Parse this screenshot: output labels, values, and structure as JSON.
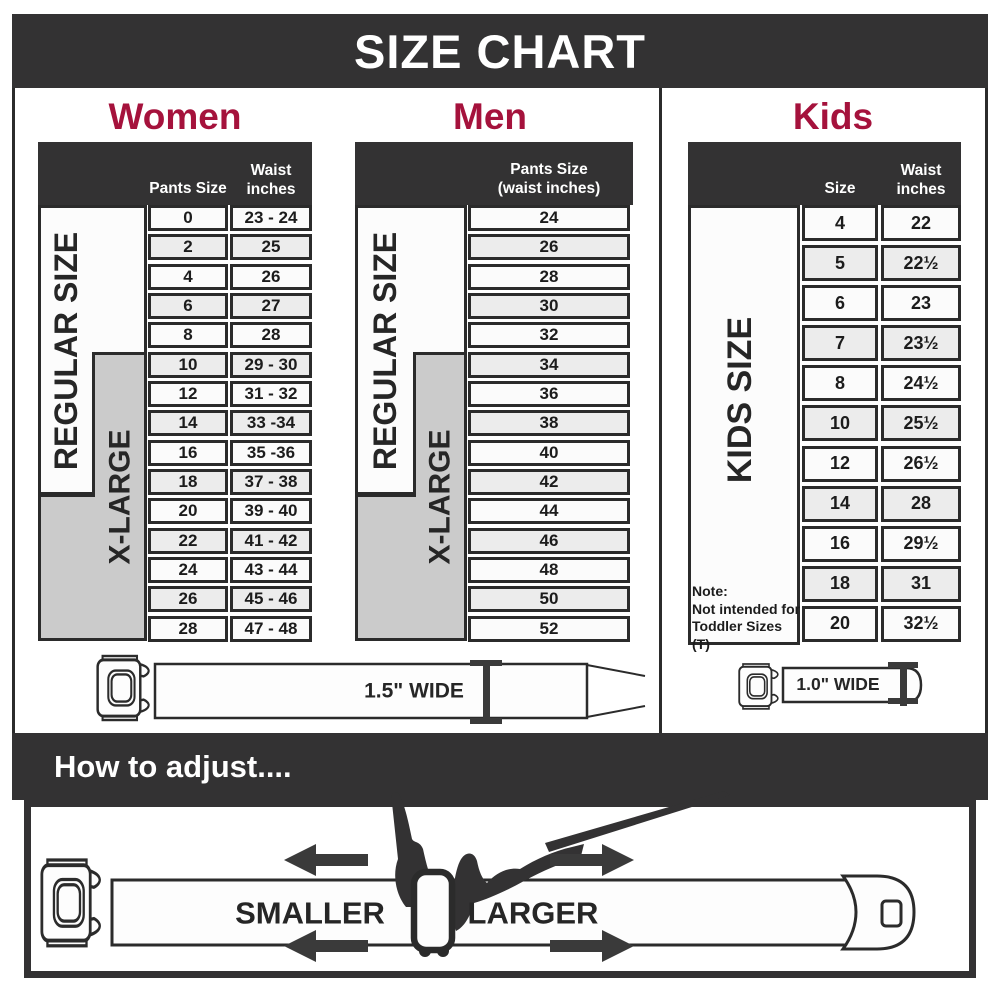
{
  "title": "SIZE CHART",
  "colors": {
    "accent_red": "#a5123c",
    "dark": "#333233",
    "gray_region": "#cbcbcb",
    "row_alt": "#ececec",
    "cell_border": "#2b2b2b"
  },
  "women": {
    "title": "Women",
    "header_size": "Pants Size",
    "header_waist_line1": "Waist",
    "header_waist_line2": "inches",
    "regular_label": "REGULAR SIZE",
    "xlarge_label": "X-LARGE",
    "rows": [
      {
        "size": "0",
        "waist": "23 - 24"
      },
      {
        "size": "2",
        "waist": "25"
      },
      {
        "size": "4",
        "waist": "26"
      },
      {
        "size": "6",
        "waist": "27"
      },
      {
        "size": "8",
        "waist": "28"
      },
      {
        "size": "10",
        "waist": "29 - 30"
      },
      {
        "size": "12",
        "waist": "31 - 32"
      },
      {
        "size": "14",
        "waist": "33 -34"
      },
      {
        "size": "16",
        "waist": "35 -36"
      },
      {
        "size": "18",
        "waist": "37 - 38"
      },
      {
        "size": "20",
        "waist": "39 - 40"
      },
      {
        "size": "22",
        "waist": "41 - 42"
      },
      {
        "size": "24",
        "waist": "43 - 44"
      },
      {
        "size": "26",
        "waist": "45 - 46"
      },
      {
        "size": "28",
        "waist": "47 - 48"
      }
    ]
  },
  "men": {
    "title": "Men",
    "header_line1": "Pants Size",
    "header_line2": "(waist inches)",
    "regular_label": "REGULAR SIZE",
    "xlarge_label": "X-LARGE",
    "sizes": [
      "24",
      "26",
      "28",
      "30",
      "32",
      "34",
      "36",
      "38",
      "40",
      "42",
      "44",
      "46",
      "48",
      "50",
      "52"
    ]
  },
  "kids": {
    "title": "Kids",
    "header_size": "Size",
    "header_waist_line1": "Waist",
    "header_waist_line2": "inches",
    "side_label": "KIDS SIZE",
    "note_line1": "Note:",
    "note_line2": "Not intended for",
    "note_line3": "Toddler Sizes (T)",
    "rows": [
      {
        "size": "4",
        "waist": "22"
      },
      {
        "size": "5",
        "waist": "22½"
      },
      {
        "size": "6",
        "waist": "23"
      },
      {
        "size": "7",
        "waist": "23½"
      },
      {
        "size": "8",
        "waist": "24½"
      },
      {
        "size": "10",
        "waist": "25½"
      },
      {
        "size": "12",
        "waist": "26½"
      },
      {
        "size": "14",
        "waist": "28"
      },
      {
        "size": "16",
        "waist": "29½"
      },
      {
        "size": "18",
        "waist": "31"
      },
      {
        "size": "20",
        "waist": "32½"
      }
    ]
  },
  "belts": {
    "adult_width_label": "1.5\" WIDE",
    "kids_width_label": "1.0\" WIDE"
  },
  "adjust": {
    "heading": "How to adjust....",
    "smaller_label": "SMALLER",
    "larger_label": "LARGER"
  }
}
